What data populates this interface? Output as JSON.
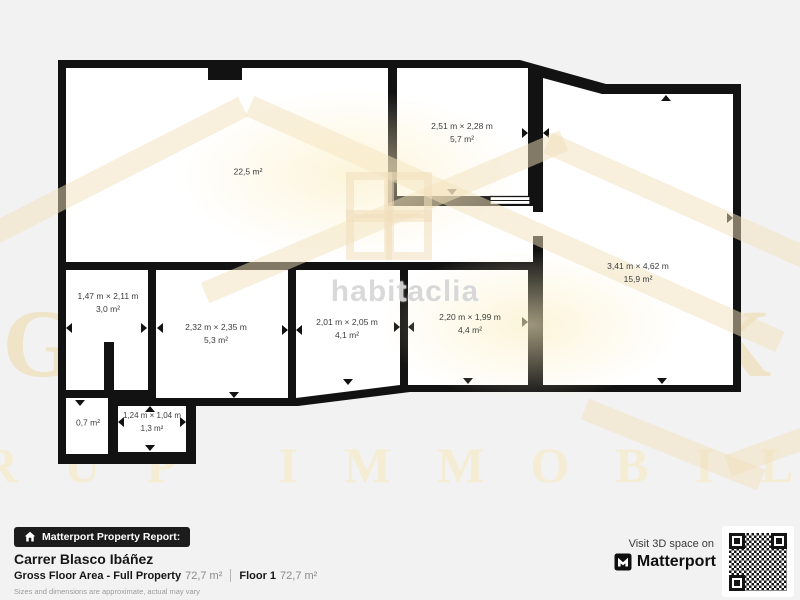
{
  "floor_plan": {
    "rooms": [
      {
        "name": "living-room",
        "dims": "",
        "area": "22,5 m²"
      },
      {
        "name": "top-room",
        "dims": "2,51 m × 2,28 m",
        "area": "5,7 m²"
      },
      {
        "name": "right-room",
        "dims": "3,41 m × 4,62 m",
        "area": "15,9 m²"
      },
      {
        "name": "left-room",
        "dims": "1,47 m × 2,11 m",
        "area": "3,0 m²"
      },
      {
        "name": "mid-room-1",
        "dims": "2,32 m × 2,35 m",
        "area": "5,3 m²"
      },
      {
        "name": "mid-room-2",
        "dims": "2,01 m × 2,05 m",
        "area": "4,1 m²"
      },
      {
        "name": "mid-room-3",
        "dims": "2,20 m × 1,99 m",
        "area": "4,4 m²"
      },
      {
        "name": "small-room-1",
        "dims": "",
        "area": "0,7 m²"
      },
      {
        "name": "small-room-2",
        "dims": "1,24 m × 1,04 m",
        "area": "1,3 m²"
      }
    ]
  },
  "watermarks": {
    "center": "habitaclia",
    "brand_word": "GOLDMARK",
    "brand_row": "RUP IMMOBILIAR"
  },
  "footer": {
    "badge": "Matterport Property Report:",
    "property_name": "Carrer Blasco Ibáñez",
    "gross_label": "Gross Floor Area - Full Property",
    "gross_value": "72,7 m²",
    "floor_label": "Floor 1",
    "floor_value": "72,7 m²",
    "disclaimer": "Sizes and dimensions are approximate, actual may vary",
    "visit_text": "Visit 3D space on",
    "brand": "Matterport"
  },
  "colors": {
    "background": "#f2f2f2",
    "walls": "#121212",
    "rooms": "#ffffff",
    "watermark_cream": "#f1dfbc",
    "badge_bg": "#1c1c1c"
  }
}
